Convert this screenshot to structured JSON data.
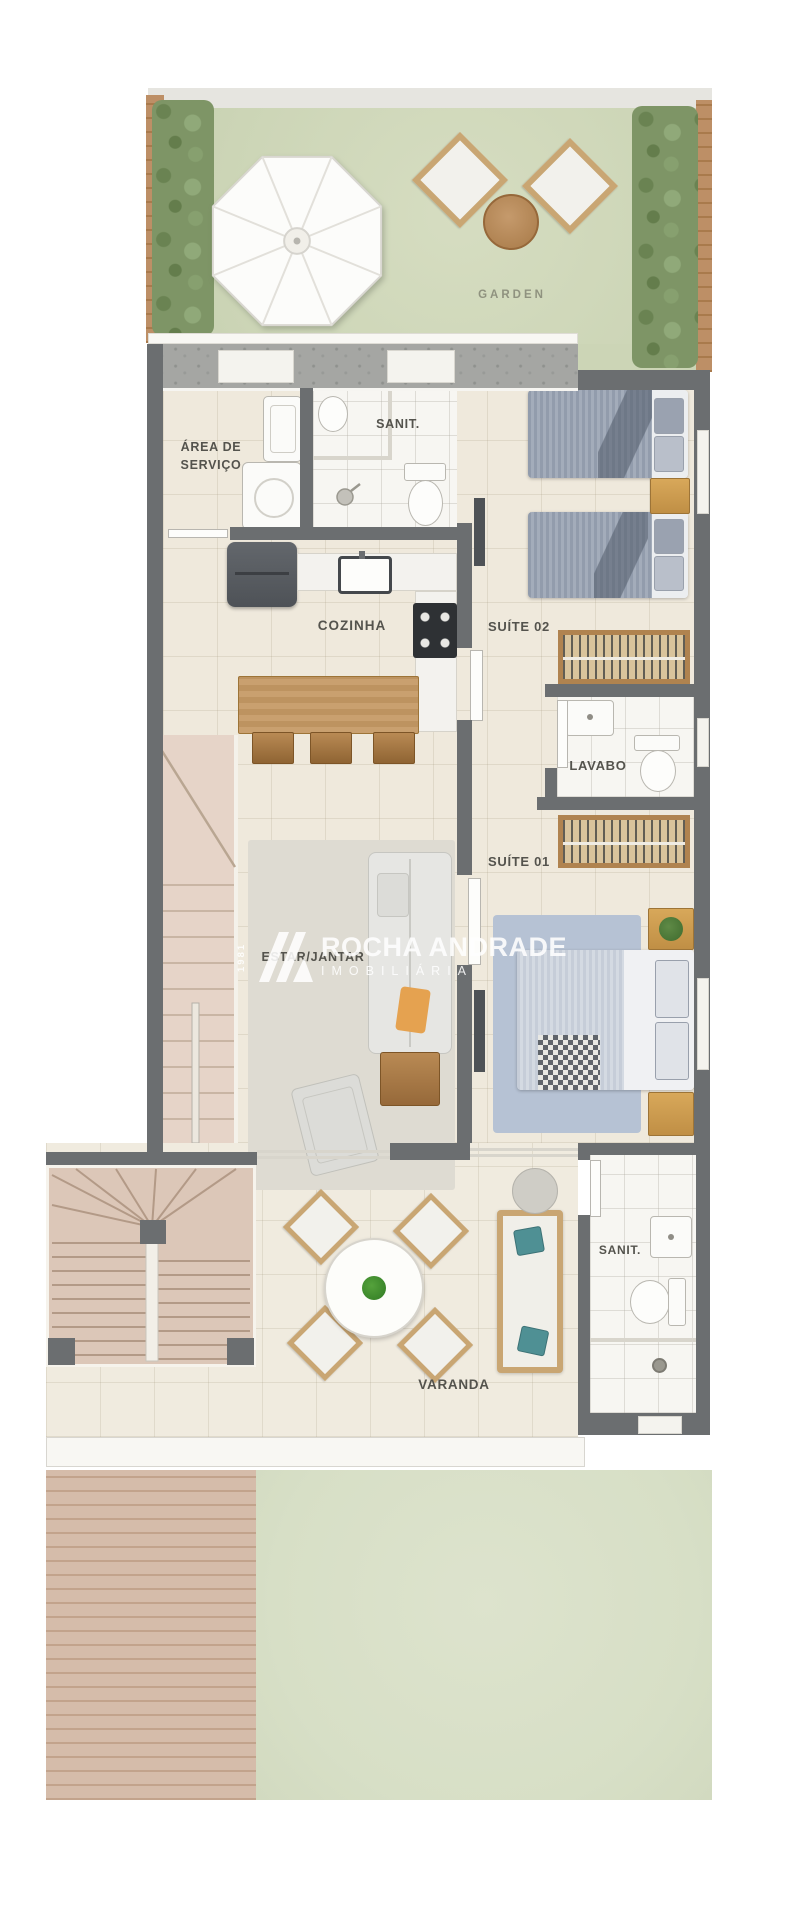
{
  "garden": {
    "label": "GARDEN"
  },
  "rooms": {
    "area_de_servico_line1": "ÁREA DE",
    "area_de_servico_line2": "SERVIÇO",
    "sanit_upper": "SANIT.",
    "cozinha": "COZINHA",
    "suite_02": "SUÍTE 02",
    "lavabo": "LAVABO",
    "suite_01": "SUÍTE 01",
    "estar_jantar": "ESTAR/JANTAR",
    "sanit_varanda": "SANIT.",
    "varanda": "VARANDA"
  },
  "watermark": {
    "year": "1981",
    "brand": "ROCHA ANDRADE",
    "subtitle": "IMOBILIÁRIA"
  },
  "colors": {
    "wall": "#6b6e70",
    "floor_cream": "#efe9dc",
    "bathroom_white": "#f7f6f2",
    "garden_green": "#d0d8bc",
    "grass_green": "#dbe2cc",
    "deck_wood": "#d5bcaa",
    "furniture_wood": "#c49a6c",
    "label_text": "#54534d",
    "watermark_white": "#ffffff"
  }
}
